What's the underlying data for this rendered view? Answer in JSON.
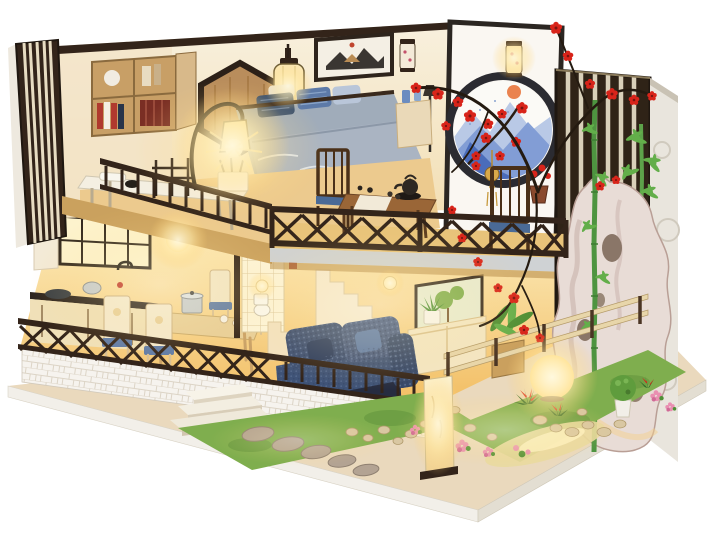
{
  "meta": {
    "kind": "product-photo",
    "subject": "Two-storey DIY miniature dollhouse diorama in Chinese modern style, interior lit with warm LEDs, photographed on a plain white background",
    "floors": 2
  },
  "colors": {
    "bg": "#ffffff",
    "wood-dark": "#33241a",
    "wood-mid": "#8a5a33",
    "wood-light": "#c89f66",
    "cream-wall": "#f7eeda",
    "cream-warm": "#f3dfb4",
    "warm-floor": "#e8c37a",
    "glow-core": "#fff8dc",
    "navy-sofa": "#3f5377",
    "navy-deep": "#2c3d60",
    "denim": "#5d7aa8",
    "bed-gray": "#a0acba",
    "fascia": "#cfd2d4",
    "brick-white": "#f6f3ee",
    "brick-line": "#dcd4c6",
    "grass": "#7fae4e",
    "grass-dark": "#5d8f3a",
    "stone": "#b3a393",
    "pebble": "#d9c7a2",
    "blossom-red": "#d8241a",
    "leaf": "#4e8f35",
    "bamboo": "#4e9440",
    "bamboo-leaf": "#63ae4a",
    "rock": "#e8dcd6",
    "rock-shade": "#cdb8b0",
    "moon-blue": "#4a6cba",
    "moon-blue-light": "#b9c9e6",
    "sun": "#e87840",
    "base-tan": "#ead9bd",
    "base-edge": "#f2efe9",
    "screen-slat": "#d9d0ba",
    "rail-wood": "#e8d6aa",
    "pink": "#e98fb1",
    "gold": "#d9a94a",
    "lantern-paper": "#fbe9b8",
    "cabinet-cream": "#f0e0b8",
    "counter-dark": "#2f2620",
    "steel": "#c6ccd1"
  },
  "scene": {
    "base": {
      "platform": "light wood display board",
      "skirt": "white brick foundation wall",
      "steps": 3
    },
    "ground_floor": {
      "kitchen": [
        "black lattice window",
        "white tall cabinet",
        "cream lower cabinets",
        "dark countertop",
        "wok",
        "steel pot",
        "faucet",
        "glowing pendant lamp"
      ],
      "dining": [
        "light wood table",
        "four cream chairs with blue cushions",
        "steel stock pot",
        "white bowls"
      ],
      "living": [
        "navy chunky-knit sofa with cushions",
        "cream sideboard",
        "aloe in white pot",
        "round table lamp",
        "framed botanical print",
        "wall sconce",
        "tall potted palm on wood stand"
      ],
      "stairs": "cream two-flight staircase to the loft",
      "bath_nook": "white tiled corner with toilet"
    },
    "second_floor": {
      "bedroom": [
        "wood bookshelf with books and white sphere",
        "hexagonal wood wall decor",
        "white desk with pen box",
        "black arc desk lamp glowing",
        "grey bed with floral throw",
        "navy and denim pillows",
        "framed mountain print",
        "glowing paper hanging lantern",
        "bedside cabinet with blue vases",
        "black floor lamp"
      ],
      "tea_balcony": [
        "dark X-lattice railing",
        "two dark wood chairs with indigo cushions",
        "tea table with white runner",
        "black cast-iron teapot",
        "tea cups",
        "gold wind-chime ornament",
        "potted red plum"
      ]
    },
    "right_wall_garden": [
      "white moon-gate panel with indigo mountain painting, orange sun and plum branch",
      "two paper wall lanterns",
      "dark vertical slat screen",
      "white relief outer wall",
      "taihu scholar rock with holes",
      "bamboo stalks",
      "red plum blossom branches"
    ],
    "front_garden": [
      "two grass strips",
      "five stepping stones",
      "pebble clusters",
      "pink flower bushes",
      "red bromeliad flowers",
      "ball topiary in white vase",
      "glowing globe lamp",
      "glowing rectangular paper floor lamp",
      "reflective pond with lotus",
      "low wooden rail fence"
    ],
    "lighting": [
      "desk arc lamp",
      "hanging lantern",
      "kitchen pendant",
      "stair sconce",
      "living sconce",
      "moon-wall lantern",
      "garden globe lamp",
      "paper floor lamp"
    ]
  }
}
